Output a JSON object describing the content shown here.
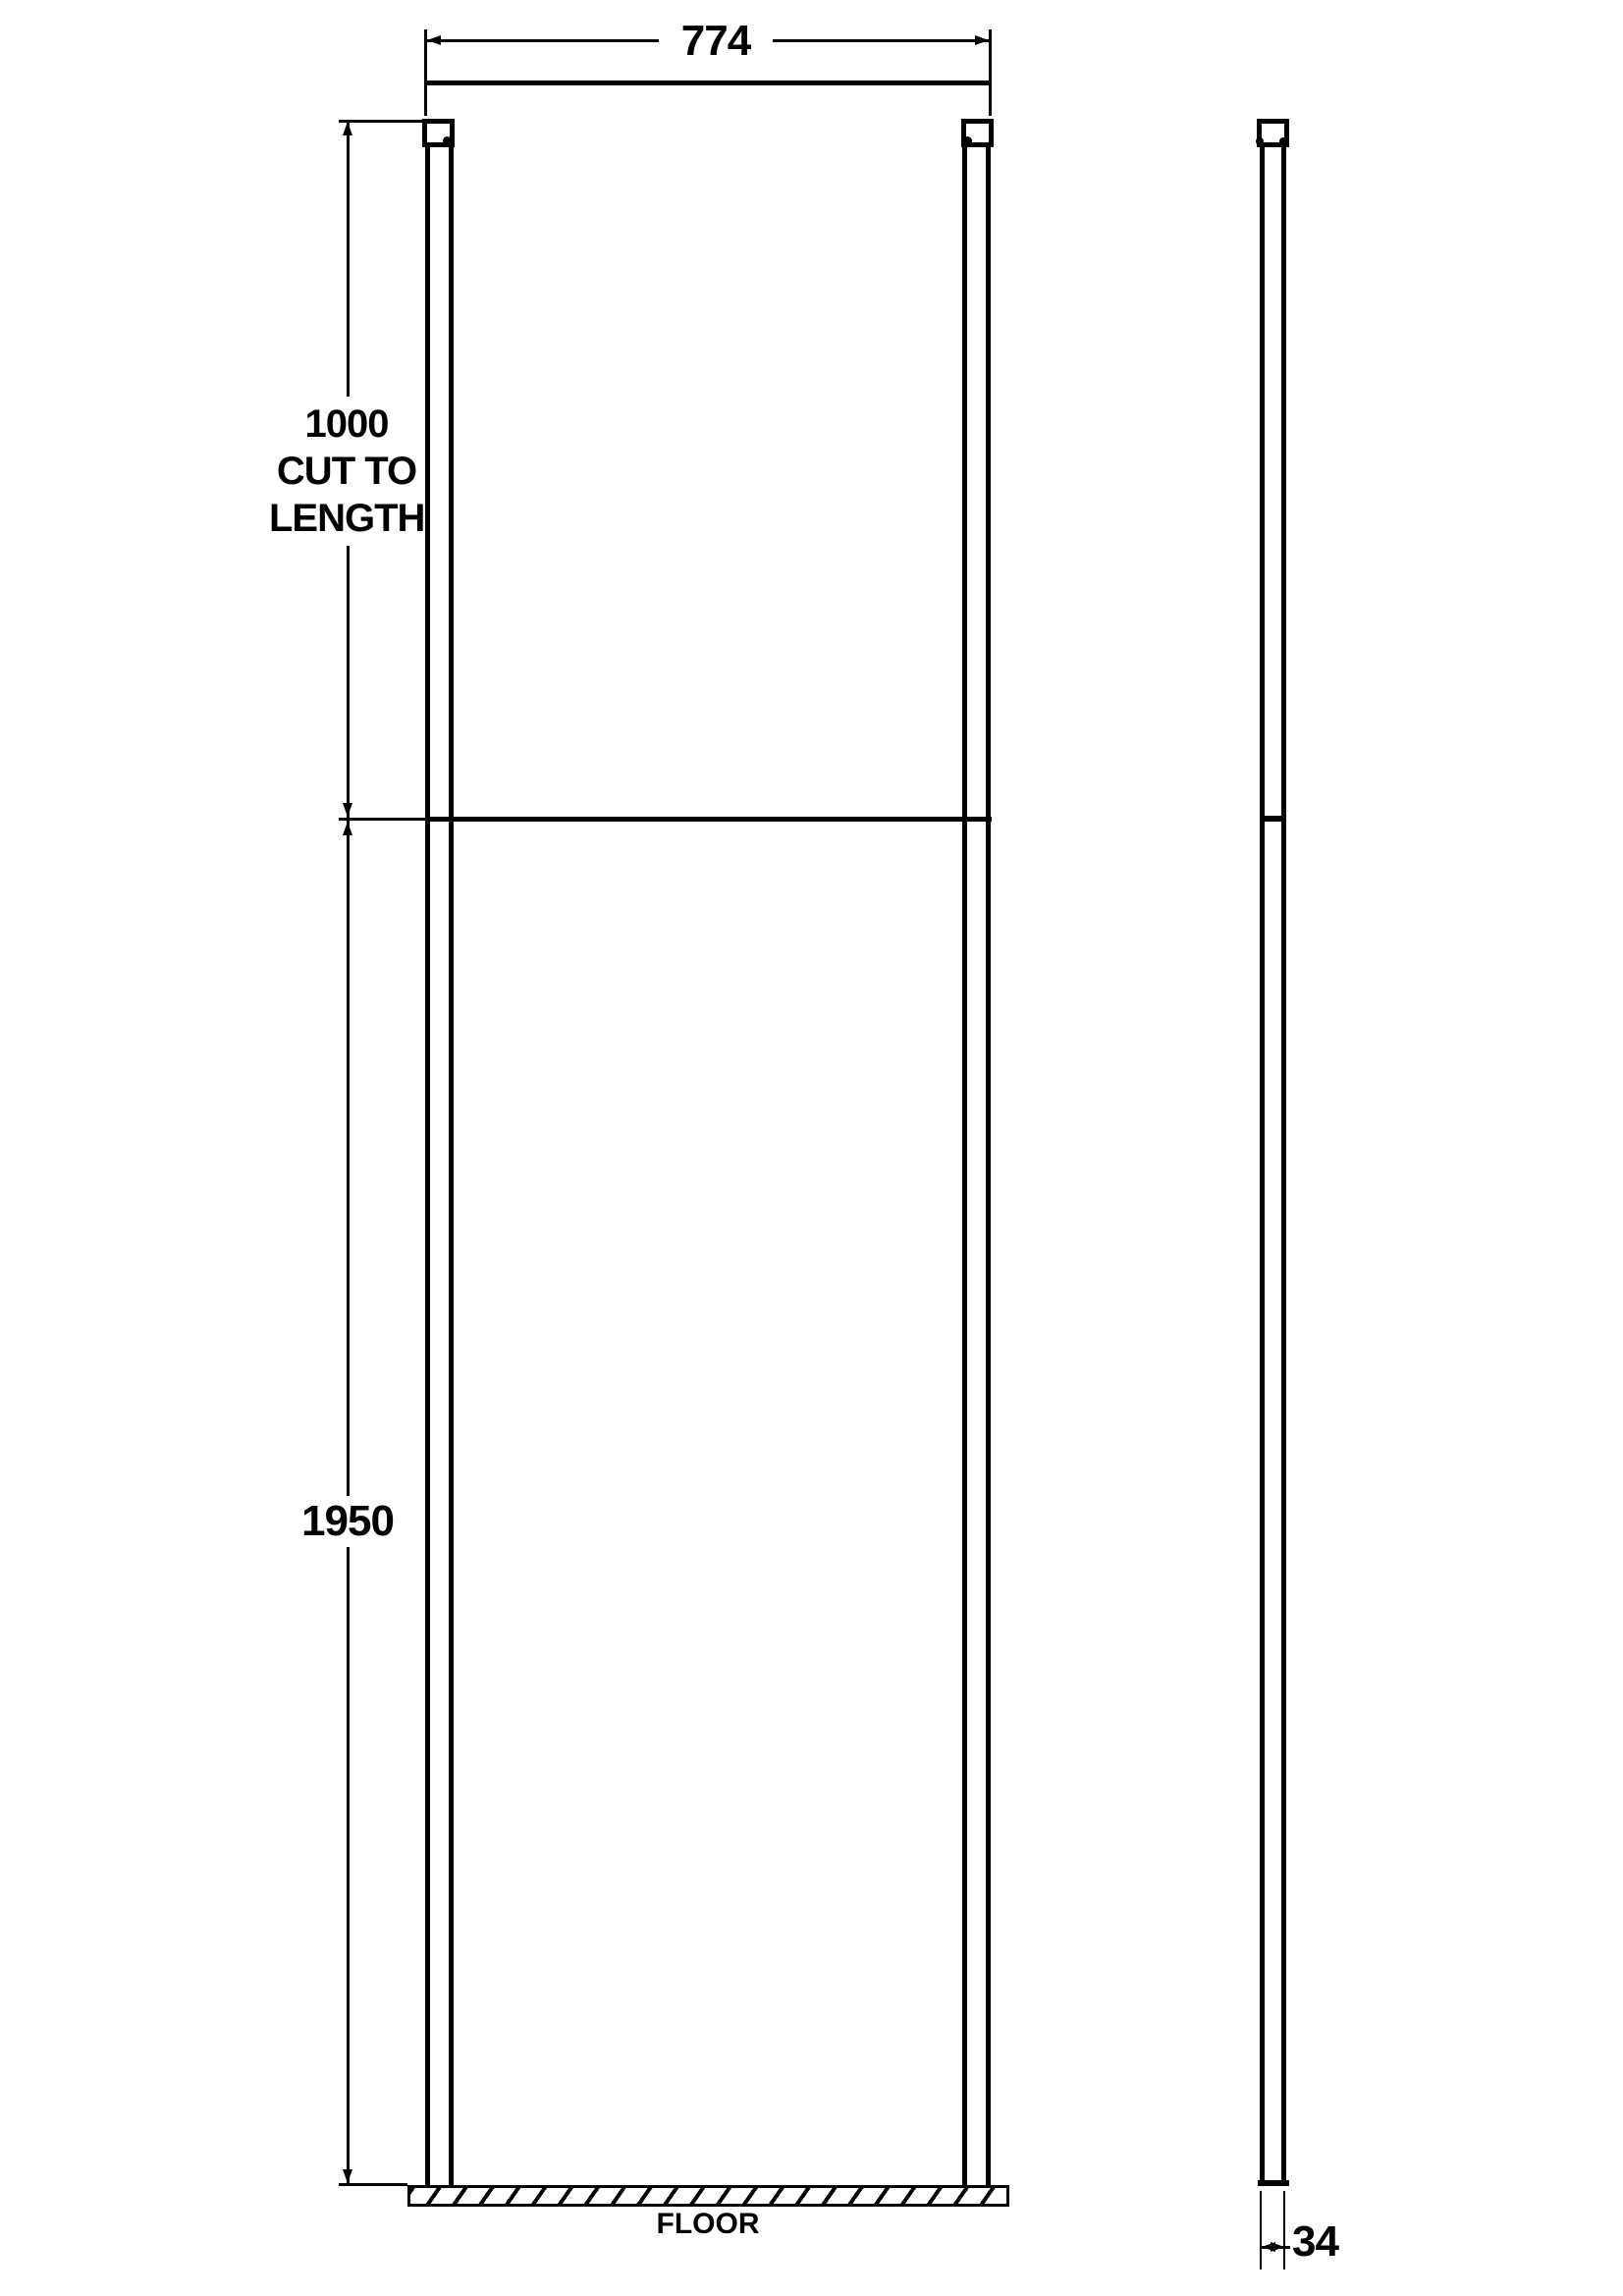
{
  "front_view": {
    "width_dim": "774",
    "post_dim_value": "1000",
    "post_dim_note_line1": "CUT TO",
    "post_dim_note_line2": "LENGTH",
    "glass_height_dim": "1950",
    "floor_label": "FLOOR"
  },
  "side_view": {
    "thickness_dim": "34"
  },
  "colors": {
    "line": "#000000",
    "background": "#ffffff"
  }
}
